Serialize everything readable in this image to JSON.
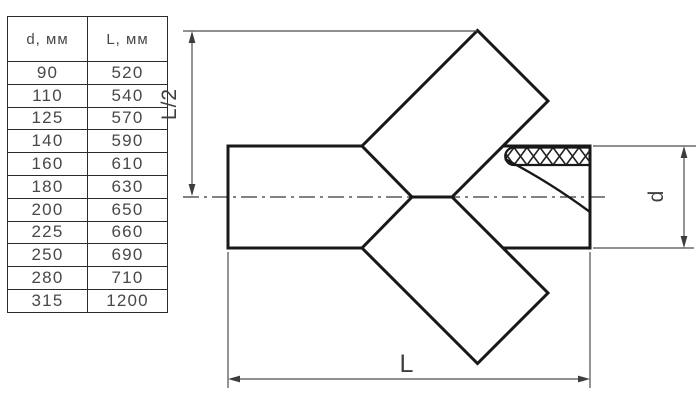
{
  "title": "Pipe Y-cross fitting dimension drawing",
  "colors": {
    "background": "#ffffff",
    "outline": "#181818",
    "dimension_lines": "#4d4d4d",
    "table_border": "#2b2b2b",
    "text": "#484848"
  },
  "table": {
    "columns": [
      "d, мм",
      "L, мм"
    ],
    "rows": [
      [
        "90",
        "520"
      ],
      [
        "110",
        "540"
      ],
      [
        "125",
        "570"
      ],
      [
        "140",
        "590"
      ],
      [
        "160",
        "610"
      ],
      [
        "180",
        "630"
      ],
      [
        "200",
        "650"
      ],
      [
        "225",
        "660"
      ],
      [
        "250",
        "690"
      ],
      [
        "280",
        "710"
      ],
      [
        "315",
        "1200"
      ]
    ]
  },
  "diagram": {
    "dimension_labels": {
      "half_length": "L/2",
      "length": "L",
      "diameter": "d"
    }
  }
}
